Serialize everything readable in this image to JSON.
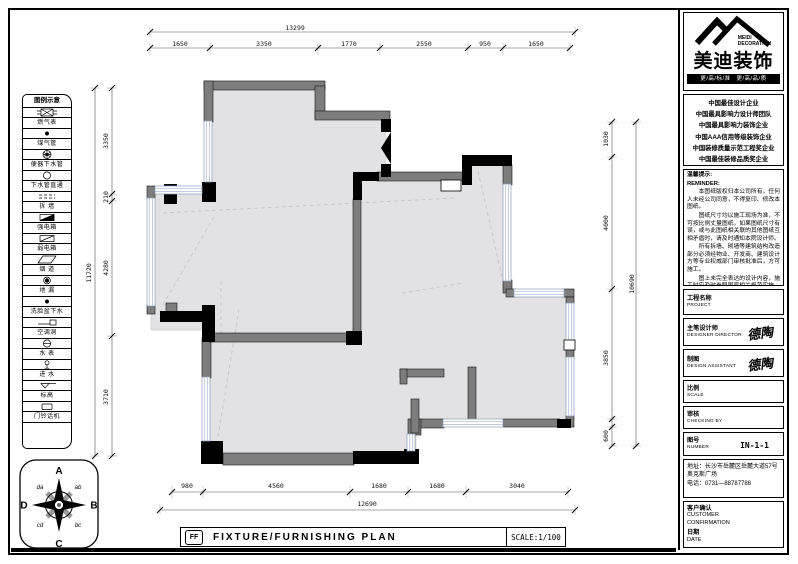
{
  "palette": {
    "paper": "#ffffff",
    "wall_gray": "#7d7d7d",
    "floor_gray": "#e2e2e4",
    "ink": "#000000",
    "window_blue": "#aab9d0"
  },
  "header_logo": {
    "company_en_1": "MEIDI",
    "company_en_2": "DECORATION",
    "company_zh": "美迪装饰",
    "slogan": "更/高/标/准　更/高/品/质"
  },
  "accolades": [
    "中国最佳设计企业",
    "中国最具影响力设计师团队",
    "中国最具影响力装饰企业",
    "中国AAA信用等级装饰企业",
    "中国装修质量示范工程奖企业",
    "中国最佳装修品质奖企业"
  ],
  "notes": {
    "title_zh": "温馨提示:",
    "title_en": "REMINDER:",
    "paragraphs": [
      "本图纸版权归本公司所有，任何人未经公司同意，不得复印、修改本图纸。",
      "图纸尺寸均以施工现场为准，不可按比例丈量图纸，如果图纸尺寸有误，或与此图纸相关联的其他图纸互相矛盾时，请及时通知本院设计师。",
      "所有拆墙、砌墙等建筑结构改造部分必须经物业、开发商、建筑设计方等专业权威部门审核批准后，方可施工。",
      "图上未完全表达的设计内容，施工时应及时参照国家相关规范实施。",
      "如未在本公司施工，以后出现一切责任与本公司无关。"
    ]
  },
  "title_block": {
    "project": {
      "zh": "工程名称",
      "en": "PROJECT"
    },
    "designer": {
      "zh": "主笔设计师",
      "en": "DESIGNER DIRECTOR",
      "signature": "德陶"
    },
    "drafter": {
      "zh": "制图",
      "en": "DESIGN ASSISTANT",
      "signature": "德陶"
    },
    "scale": {
      "zh": "比例",
      "en": "SCALE"
    },
    "checker": {
      "zh": "审核",
      "en": "CHECKING BY"
    },
    "number": {
      "zh": "图号",
      "en": "NUMBER",
      "value": "IN-1-1"
    }
  },
  "contact": {
    "address": "地址：长沙市岳麓区岳麓大道57号奥克斯广场",
    "phone": "电话：0731—88787786"
  },
  "confirmation": {
    "customer_zh": "客户确认",
    "customer_en_1": "CUSTOMER",
    "customer_en_2": "CONFIRMATION",
    "date_zh": "日期",
    "date_en": "DATE"
  },
  "legend": {
    "title": "图例示意",
    "items": [
      {
        "symbol": "gas-meter",
        "label": "燃气表"
      },
      {
        "symbol": "gas-pipe",
        "label": "煤气管"
      },
      {
        "symbol": "toilet-drain",
        "label": "便器下水管"
      },
      {
        "symbol": "drain-through",
        "label": "下水管直通"
      },
      {
        "symbol": "demolish-wall",
        "label": "拆 墙"
      },
      {
        "symbol": "power-box",
        "label": "强电箱"
      },
      {
        "symbol": "weak-power-box",
        "label": "弱电箱"
      },
      {
        "symbol": "flue",
        "label": "烟 道"
      },
      {
        "symbol": "floor-drain",
        "label": "地 漏"
      },
      {
        "symbol": "basin-drain",
        "label": "洗脸盆下水"
      },
      {
        "symbol": "ac-hole",
        "label": "空调洞"
      },
      {
        "symbol": "water-meter",
        "label": "水 表"
      },
      {
        "symbol": "water-inlet",
        "label": "进 水"
      },
      {
        "symbol": "elevation",
        "label": "标高"
      },
      {
        "symbol": "door-phone",
        "label": "门铃话机"
      }
    ]
  },
  "compass": {
    "n": "A",
    "e": "B",
    "s": "C",
    "w": "D",
    "ne": "ab",
    "se": "bc",
    "sw": "cd",
    "nw": "da"
  },
  "footer": {
    "code": "FF",
    "title": "FIXTURE/FURNISHING PLAN",
    "scale": "SCALE:1/100"
  },
  "dimensions": {
    "top_total": "13299",
    "top": [
      "1650",
      "3350",
      "1770",
      "2550",
      "950",
      "1650"
    ],
    "left_total": "11720",
    "left": [
      "3350",
      "210",
      "4280",
      "3710"
    ],
    "right_total": "10690",
    "right": [
      "1030",
      "4000",
      "3850",
      "600"
    ],
    "bottom_total": "12690",
    "bottom": [
      "980",
      "4560",
      "1680",
      "1680",
      "3040"
    ]
  }
}
